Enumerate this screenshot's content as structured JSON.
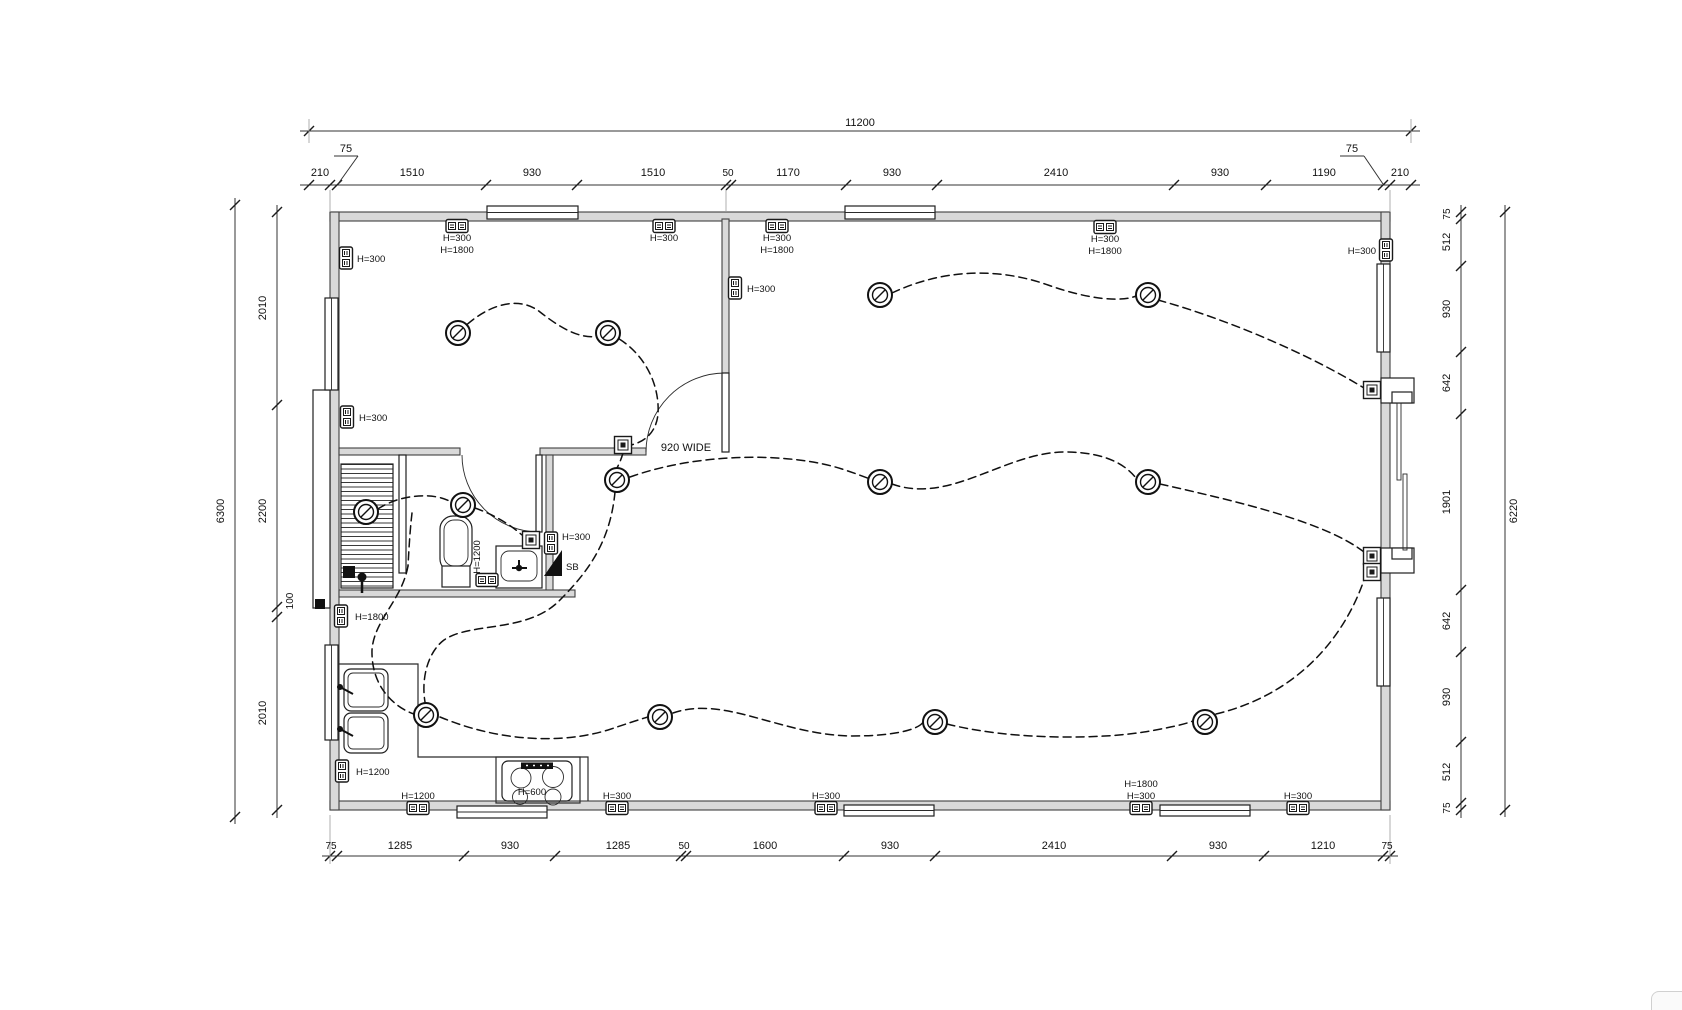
{
  "plan": {
    "door_label": "920 WIDE",
    "labels": {
      "h300": "H=300",
      "h1800": "H=1800",
      "h1200": "H=1200",
      "h600": "H=600",
      "sb": "SB"
    },
    "dimensions": {
      "top_overall": "11200",
      "top": [
        "210",
        "75",
        "1510",
        "930",
        "1510",
        "50",
        "1170",
        "930",
        "2410",
        "930",
        "1190",
        "75",
        "210"
      ],
      "bottom": [
        "75",
        "1285",
        "930",
        "1285",
        "50",
        "1600",
        "930",
        "2410",
        "930",
        "1210",
        "75"
      ],
      "left_overall": "6300",
      "left": [
        "2010",
        "2200",
        "100",
        "2010"
      ],
      "right_overall": "6220",
      "right": [
        "75",
        "512",
        "930",
        "642",
        "1901",
        "642",
        "930",
        "512",
        "75"
      ]
    }
  }
}
